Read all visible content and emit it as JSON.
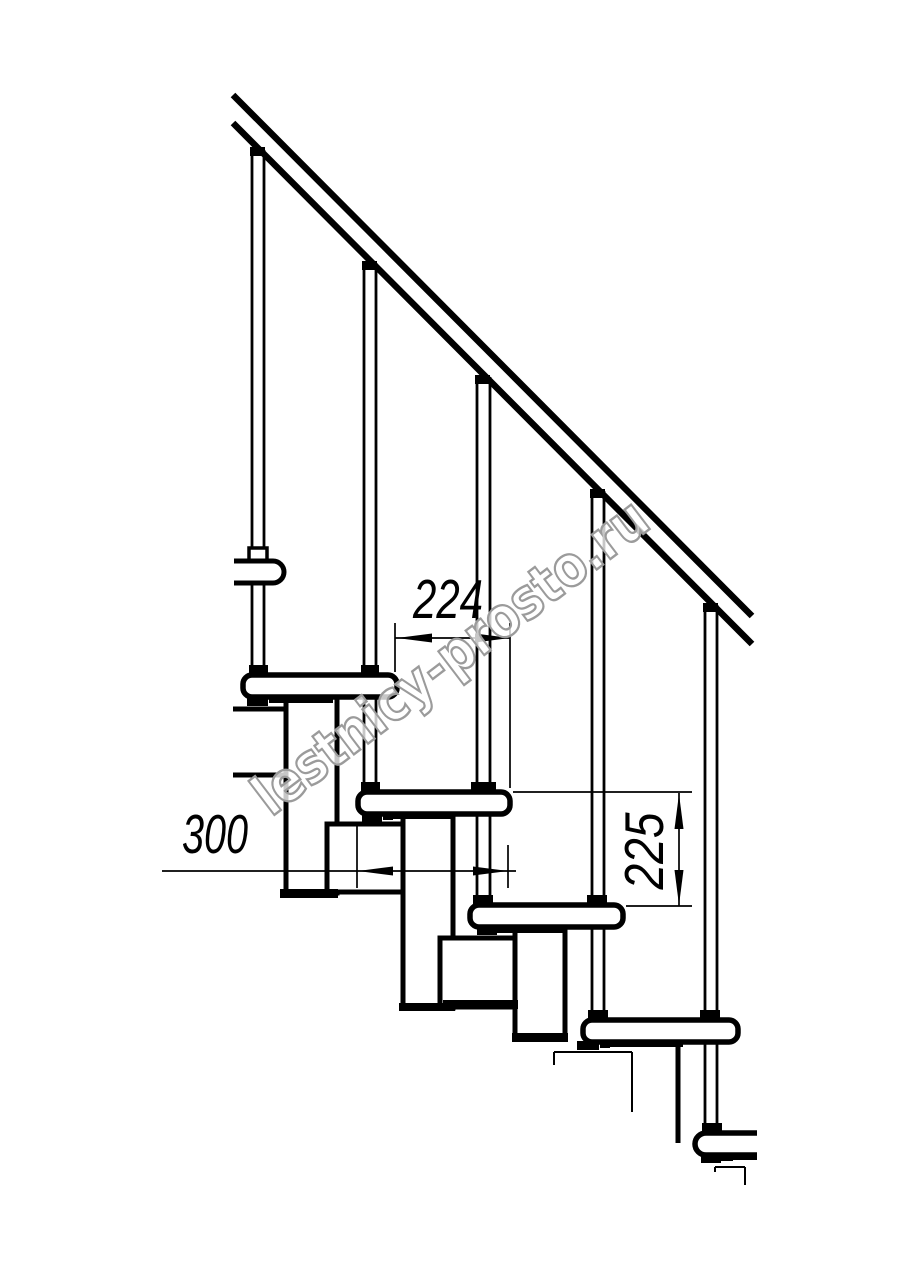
{
  "page": {
    "background": "#ffffff"
  },
  "drawing": {
    "line_color": "#000000",
    "dimensions": [
      {
        "name": "step-run-mm",
        "label": "224"
      },
      {
        "name": "tread-depth-mm",
        "label": "300"
      },
      {
        "name": "step-rise-mm",
        "label": "225"
      }
    ],
    "watermark": {
      "text": "lestnicy-prosto.ru",
      "color": "#9b9b9b"
    }
  }
}
